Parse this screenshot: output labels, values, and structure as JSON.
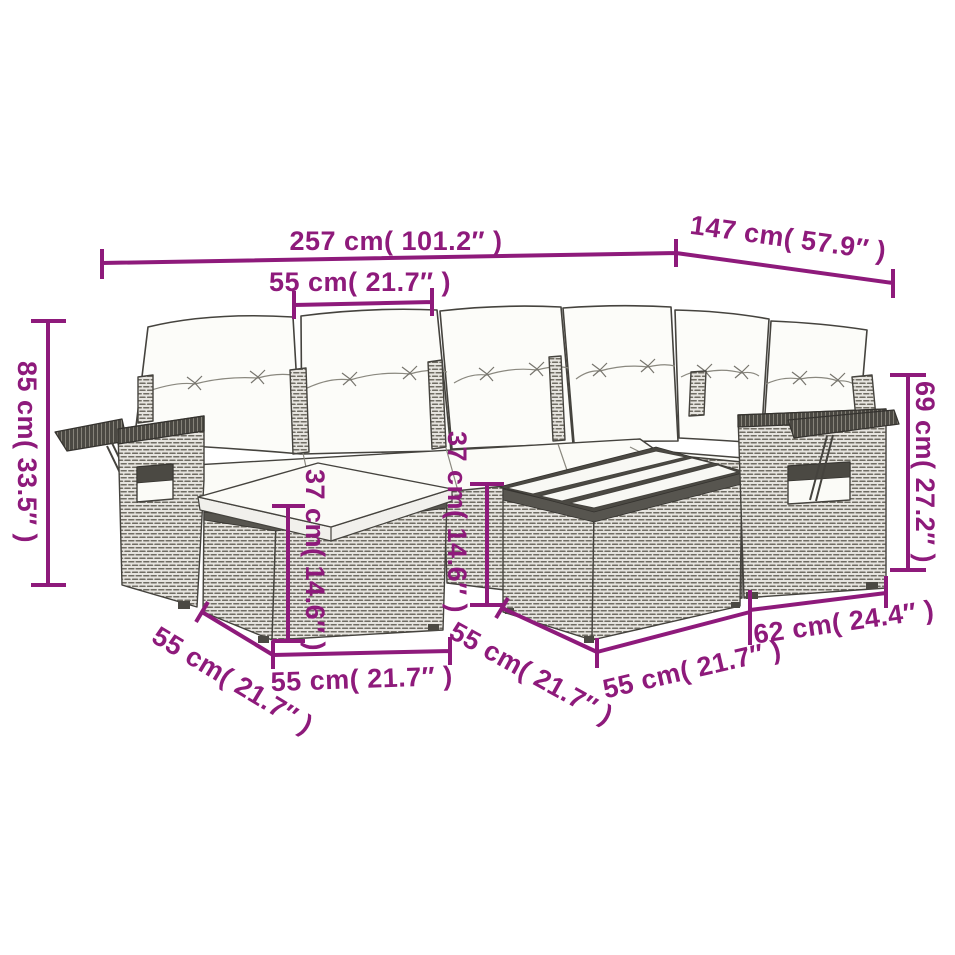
{
  "diagram": {
    "kind": "furniture-dimension-diagram",
    "subject": "rattan garden corner sofa set with cushions, footstool, fold-out side trays and slatted coffee table",
    "background_color": "#ffffff",
    "accent_color": "#8e1a7b",
    "wicker_color": "#e7e5e0",
    "cushion_color": "#fcfcf9"
  },
  "dimensions": {
    "total_width": "257 cm( 101.2″ )",
    "total_depth": "147 cm( 57.9″ )",
    "seat_width": "55 cm( 21.7″ )",
    "back_height": "85 cm( 33.5″ )",
    "arm_height": "69 cm( 27.2″ )",
    "footstool_height": "37 cm( 14.6″ )",
    "table_height": "37 cm( 14.6″ )",
    "footstool_depth": "55 cm( 21.7″ )",
    "footstool_width": "55 cm( 21.7″ )",
    "table_depth": "55 cm( 21.7″ )",
    "table_width": "55 cm( 21.7″ )",
    "armrest_section_depth": "62 cm( 24.4″ )"
  }
}
